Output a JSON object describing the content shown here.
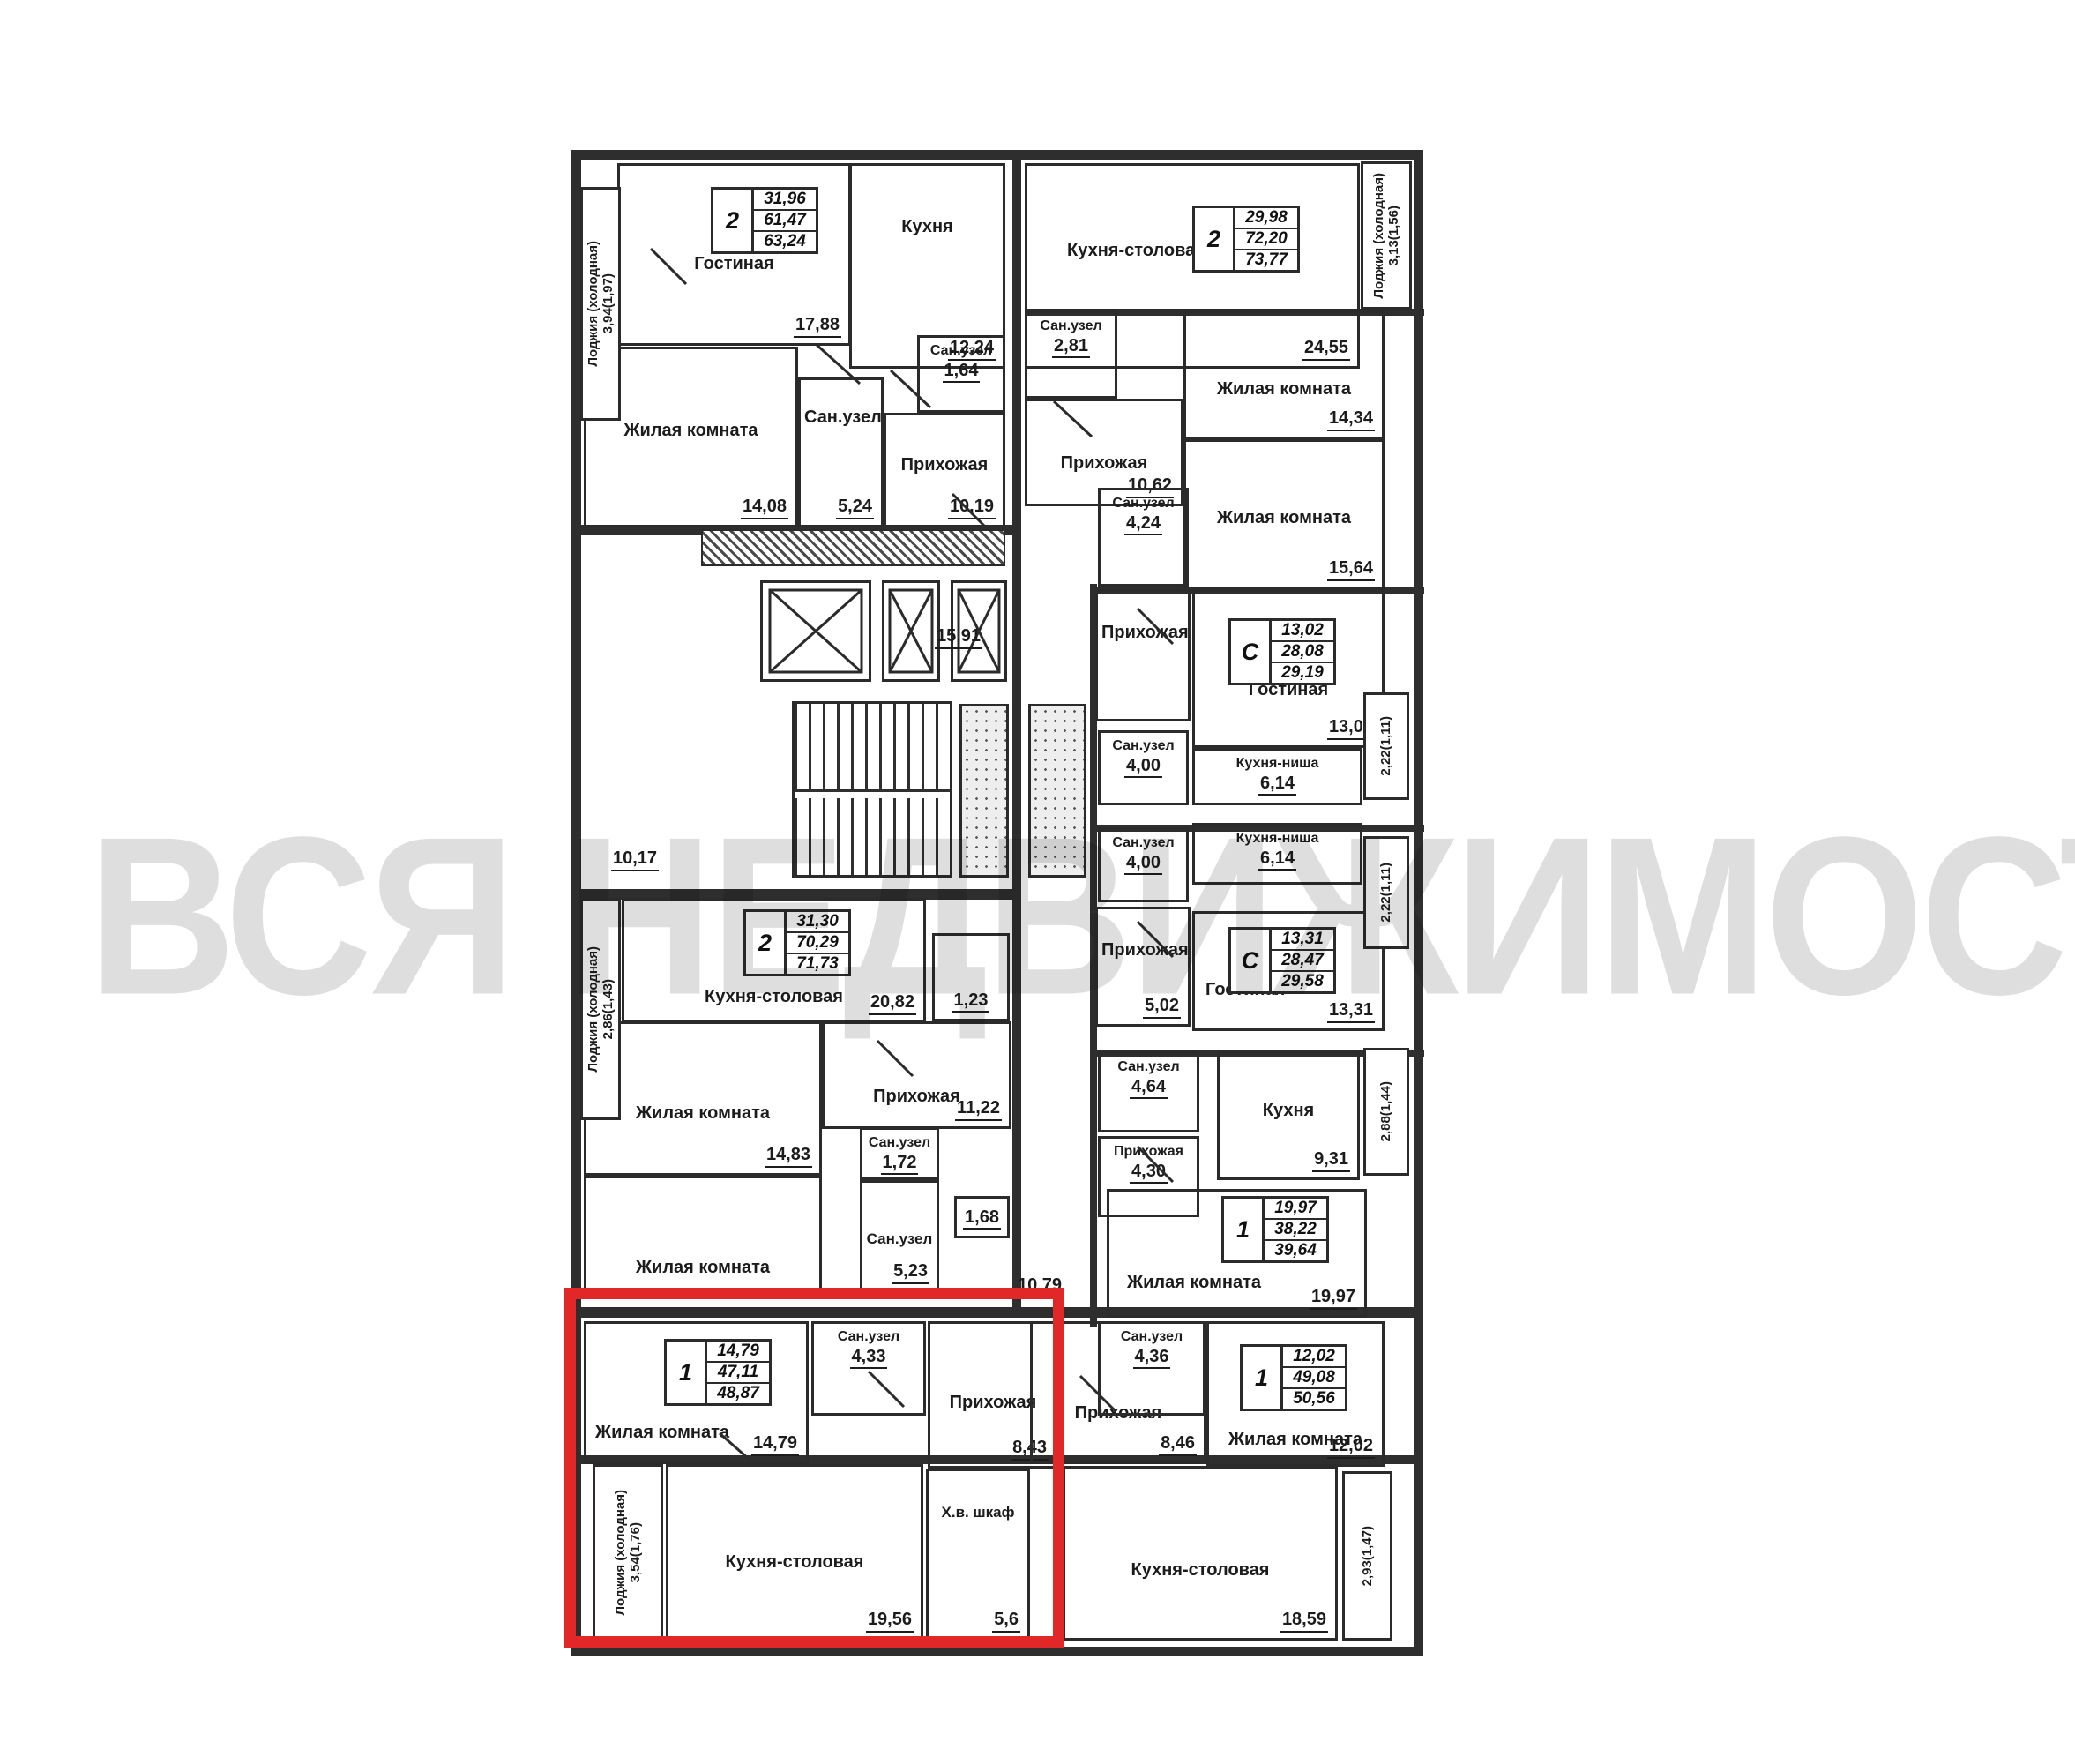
{
  "watermark": {
    "text": "ВСЯ НЕДВИЖИМОСТЬ"
  },
  "highlight": {
    "color": "#e12727"
  },
  "rooms": [
    {
      "label": "Гостиная",
      "area": "17,88"
    },
    {
      "label": "Кухня",
      "area": "12,24"
    },
    {
      "label": "Жилая комната",
      "area": "14,08"
    },
    {
      "label": "Сан.узел",
      "area": "5,24"
    },
    {
      "label": "Сан.узел",
      "area": "1,64"
    },
    {
      "label": "Прихожая",
      "area": "10,19"
    },
    {
      "label": "Кухня-столовая",
      "area": "24,55"
    },
    {
      "label": "Сан.узел",
      "area": "2,81"
    },
    {
      "label": "Прихожая",
      "area": "10,62"
    },
    {
      "label": "Жилая комната",
      "area": "14,34"
    },
    {
      "label": "Жилая комната",
      "area": "15,64"
    },
    {
      "label": "Сан.узел",
      "area": "4,24"
    },
    {
      "label": "Прихожая",
      "area": ""
    },
    {
      "label": "Сан.узел",
      "area": "4,00"
    },
    {
      "label": "Гостиная",
      "area": "13,02"
    },
    {
      "label": "Кухня-ниша",
      "area": "6,14"
    },
    {
      "label": "Сан.узел",
      "area": "4,00"
    },
    {
      "label": "Кухня-ниша",
      "area": "6,14"
    },
    {
      "label": "Прихожая",
      "area": "5,02"
    },
    {
      "label": "Гостиная",
      "area": "13,31"
    },
    {
      "label": "Сан.узел",
      "area": "4,64"
    },
    {
      "label": "Кухня",
      "area": "9,31"
    },
    {
      "label": "Прихожая",
      "area": "4,30"
    },
    {
      "label": "Жилая комната",
      "area": "19,97"
    },
    {
      "label": "Кухня-столовая",
      "area": "20,82"
    },
    {
      "label": "",
      "area": "1,23"
    },
    {
      "label": "Прихожая",
      "area": "11,22"
    },
    {
      "label": "Жилая комната",
      "area": "14,83"
    },
    {
      "label": "Сан.узел",
      "area": "1,72"
    },
    {
      "label": "Сан.узел",
      "area": "5,23"
    },
    {
      "label": "",
      "area": "1,68"
    },
    {
      "label": "Жилая комната",
      "area": ""
    },
    {
      "label": "Жилая комната",
      "area": "14,79"
    },
    {
      "label": "Сан.узел",
      "area": "4,33"
    },
    {
      "label": "Прихожая",
      "area": "8,43"
    },
    {
      "label": "Кухня-столовая",
      "area": "19,56"
    },
    {
      "label": "Х.в. шкаф",
      "area": "5,6"
    },
    {
      "label": "Прихожая",
      "area": "8,46"
    },
    {
      "label": "Сан.узел",
      "area": "4,36"
    },
    {
      "label": "Жилая комната",
      "area": "12,02"
    },
    {
      "label": "Кухня-столовая",
      "area": "18,59"
    }
  ],
  "corridors": [
    {
      "area": "15,91"
    },
    {
      "area": "10,17"
    },
    {
      "area": "10,79"
    }
  ],
  "loggias": [
    {
      "label": "Лоджия (холодная)",
      "area": "3,94(1,97)"
    },
    {
      "label": "Лоджия (холодная)",
      "area": "3,13(1,56)"
    },
    {
      "label": "",
      "area": "2,22(1,11)"
    },
    {
      "label": "",
      "area": "2,22(1,11)"
    },
    {
      "label": "Лоджия (холодная)",
      "area": "2,86(1,43)"
    },
    {
      "label": "",
      "area": "2,88(1,44)"
    },
    {
      "label": "Лоджия (холодная)",
      "area": "3,54(1,76)"
    },
    {
      "label": "",
      "area": "2,93(1,47)"
    }
  ],
  "specs": [
    {
      "type": "2",
      "living": "31,96",
      "area": "61,47",
      "total": "63,24"
    },
    {
      "type": "2",
      "living": "29,98",
      "area": "72,20",
      "total": "73,77"
    },
    {
      "type": "С",
      "living": "13,02",
      "area": "28,08",
      "total": "29,19"
    },
    {
      "type": "С",
      "living": "13,31",
      "area": "28,47",
      "total": "29,58"
    },
    {
      "type": "2",
      "living": "31,30",
      "area": "70,29",
      "total": "71,73"
    },
    {
      "type": "1",
      "living": "19,97",
      "area": "38,22",
      "total": "39,64"
    },
    {
      "type": "1",
      "living": "14,79",
      "area": "47,11",
      "total": "48,87"
    },
    {
      "type": "1",
      "living": "12,02",
      "area": "49,08",
      "total": "50,56"
    }
  ]
}
